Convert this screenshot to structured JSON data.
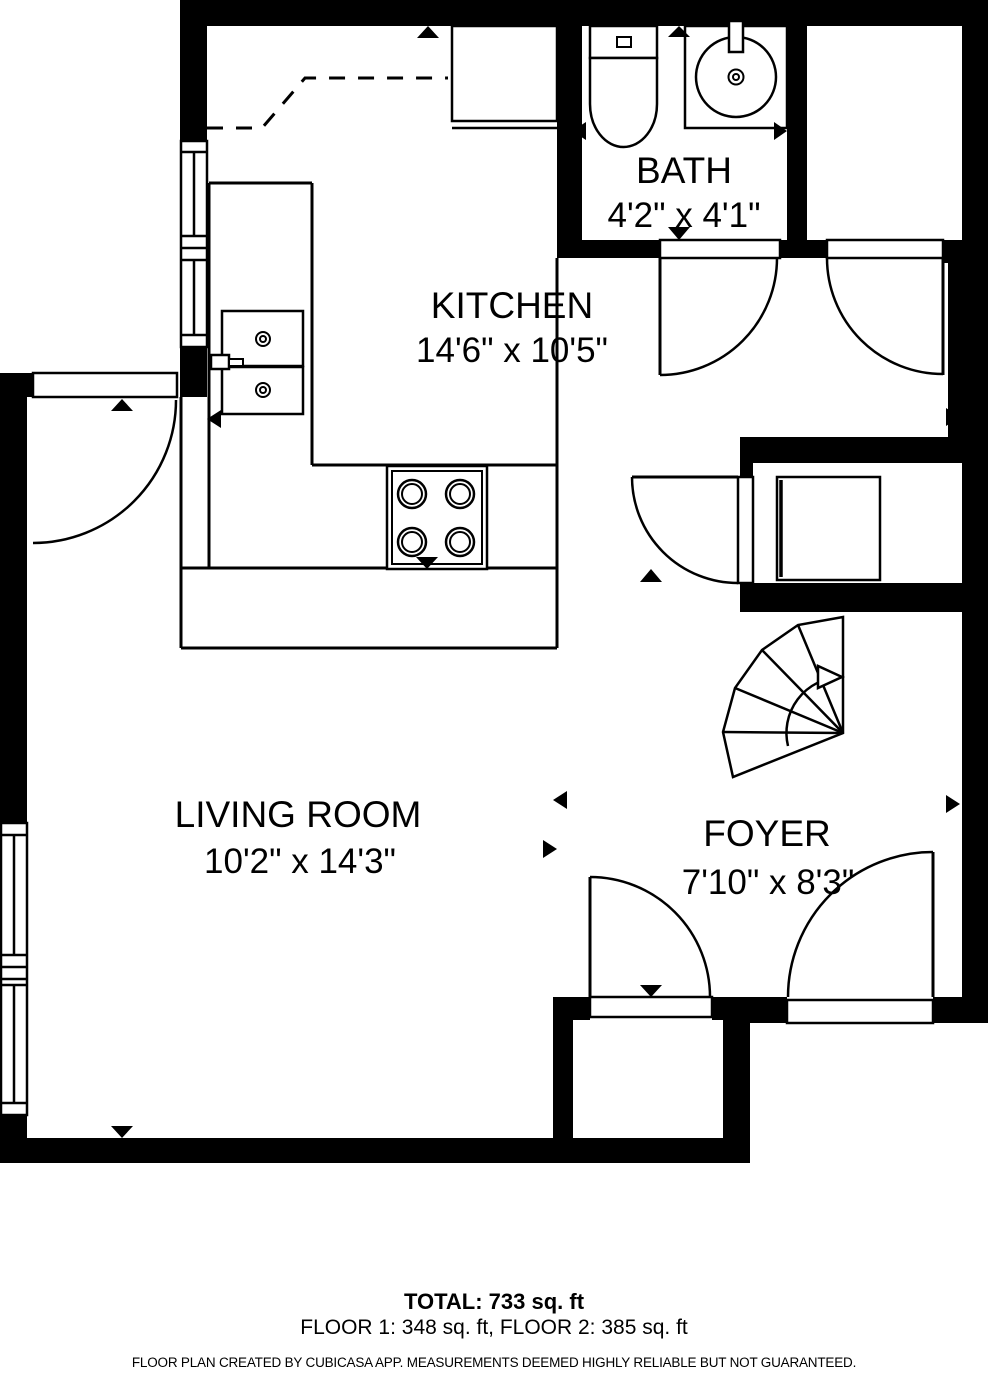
{
  "rooms": {
    "kitchen": {
      "name": "KITCHEN",
      "dims": "14'6\" x 10'5\""
    },
    "bath": {
      "name": "BATH",
      "dims": "4'2\" x 4'1\""
    },
    "living_room": {
      "name": "LIVING ROOM",
      "dims": "10'2\" x 14'3\""
    },
    "foyer": {
      "name": "FOYER",
      "dims": "7'10\" x 8'3\""
    }
  },
  "footer": {
    "total": "TOTAL: 733 sq. ft",
    "floors": "FLOOR 1: 348 sq. ft, FLOOR 2: 385 sq. ft",
    "disclaimer": "FLOOR PLAN CREATED BY CUBICASA APP. MEASUREMENTS DEEMED HIGHLY RELIABLE BUT NOT GUARANTEED."
  },
  "colors": {
    "wall": "#000000",
    "floor": "#ffffff",
    "line": "#000000"
  }
}
